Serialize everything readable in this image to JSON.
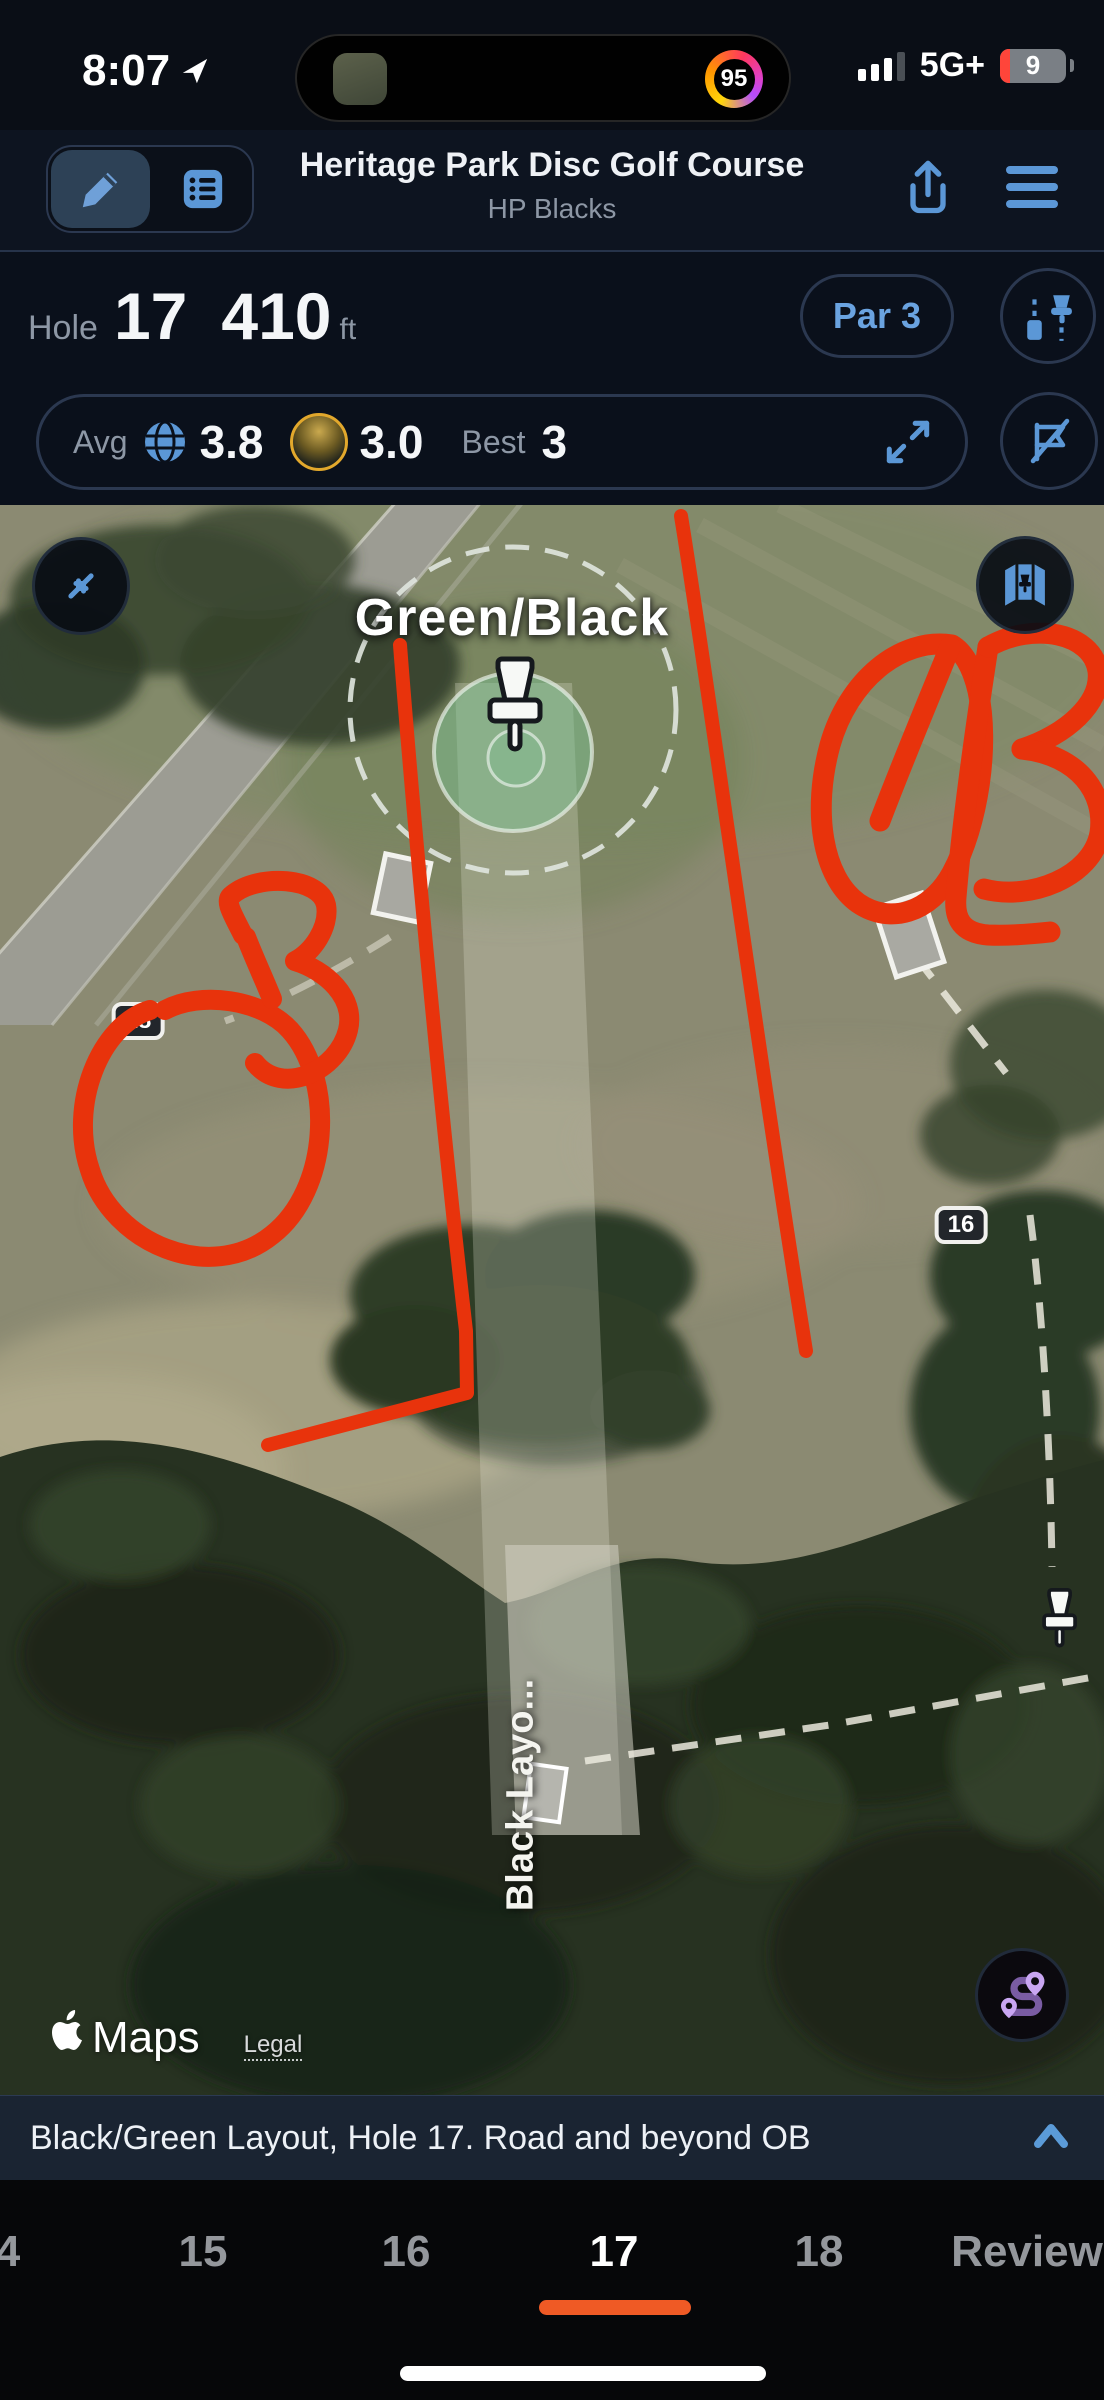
{
  "status_bar": {
    "time": "8:07",
    "activity_ring": "95",
    "network": "5G+",
    "battery_level": "9"
  },
  "header": {
    "title": "Heritage Park Disc Golf Course",
    "subtitle": "HP Blacks"
  },
  "hole_info": {
    "hole_label": "Hole",
    "hole_number": "17",
    "distance": "410",
    "distance_unit": "ft",
    "par": "Par 3"
  },
  "stats": {
    "avg_label": "Avg",
    "avg_value": "3.8",
    "player_value": "3.0",
    "best_label": "Best",
    "best_value": "3"
  },
  "map": {
    "layout_label": "Green/Black",
    "marker_18": "18",
    "marker_16": "16",
    "teepad_label": "Black Layo...",
    "attribution": "Maps",
    "legal": "Legal",
    "ob_annotation": "OB"
  },
  "note_bar": {
    "text": "Black/Green Layout, Hole 17. Road and beyond OB"
  },
  "tab_bar": {
    "items": [
      {
        "label": "4"
      },
      {
        "label": "15"
      },
      {
        "label": "16"
      },
      {
        "label": "17",
        "active": true
      },
      {
        "label": "18"
      },
      {
        "label": "Review"
      }
    ]
  },
  "colors": {
    "accent": "#5b97d6",
    "annotation_red": "#e8330c",
    "tab_underline": "#ef5a25",
    "green_circle": "#7cc698"
  }
}
